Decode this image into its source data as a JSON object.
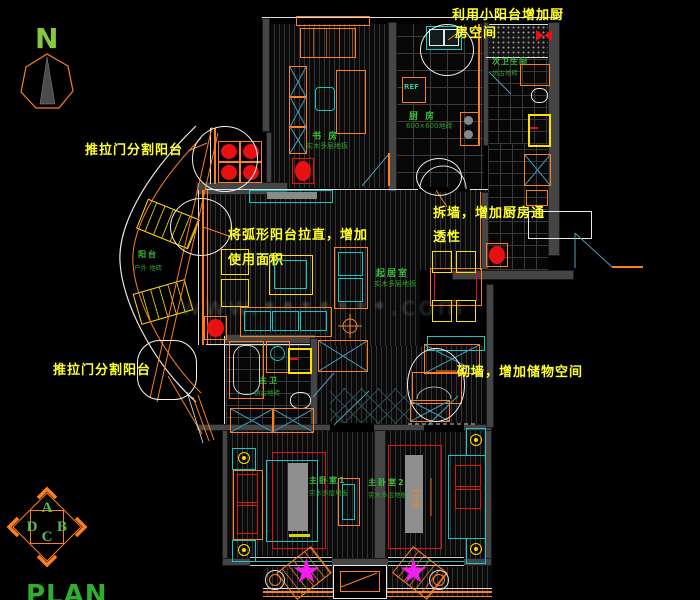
{
  "compass": {
    "north_label": "N"
  },
  "title_block": {
    "plan_label": "PLAN"
  },
  "orientation_key": {
    "top": "A",
    "right": "B",
    "bottom": "C",
    "left": "D"
  },
  "annotations": {
    "split_balcony_top": "推拉门分割阳台",
    "use_small_balcony_1": "利用小阳台增加厨",
    "use_small_balcony_2": "房空间",
    "straighten_balcony_1": "将弧形阳台拉直，增加",
    "straighten_balcony_2": "使用面积",
    "demolish_wall_1": "拆墙，增加厨房通",
    "demolish_wall_2": "透性",
    "split_balcony_bottom": "推拉门分割阳台",
    "build_wall": "砌墙，增加储物空间"
  },
  "rooms": {
    "study": {
      "name": "书 房",
      "finish": "实木多层地板"
    },
    "kitchen": {
      "name": "厨 房",
      "finish": "600×600地砖"
    },
    "bath2": {
      "name": "次卫生间",
      "finish": "仿古地砖"
    },
    "living": {
      "name": "起居室",
      "finish": "实木多层地板"
    },
    "balcony": {
      "name": "阳台",
      "finish": "户外 地砖"
    },
    "bath1": {
      "name": "主卫",
      "finish": "仿古地砖"
    },
    "bed1": {
      "name": "主卧室1",
      "finish": "实木多层地板"
    },
    "bed2": {
      "name": "主卧室2",
      "finish": "实木多层地板"
    }
  },
  "fixtures": {
    "fridge_label": "REF"
  },
  "dimensions": {
    "bed2_width": "2100"
  },
  "watermark": {
    "text": "www.•••••••.com"
  },
  "colors": {
    "annotation": "#ffff2e",
    "room_label": "#3cbf3c",
    "wall_accent": "#ff7f1e",
    "detail_blue": "#3f87a6",
    "alert_red": "#e81010",
    "plant_magenta": "#f21cf2"
  }
}
